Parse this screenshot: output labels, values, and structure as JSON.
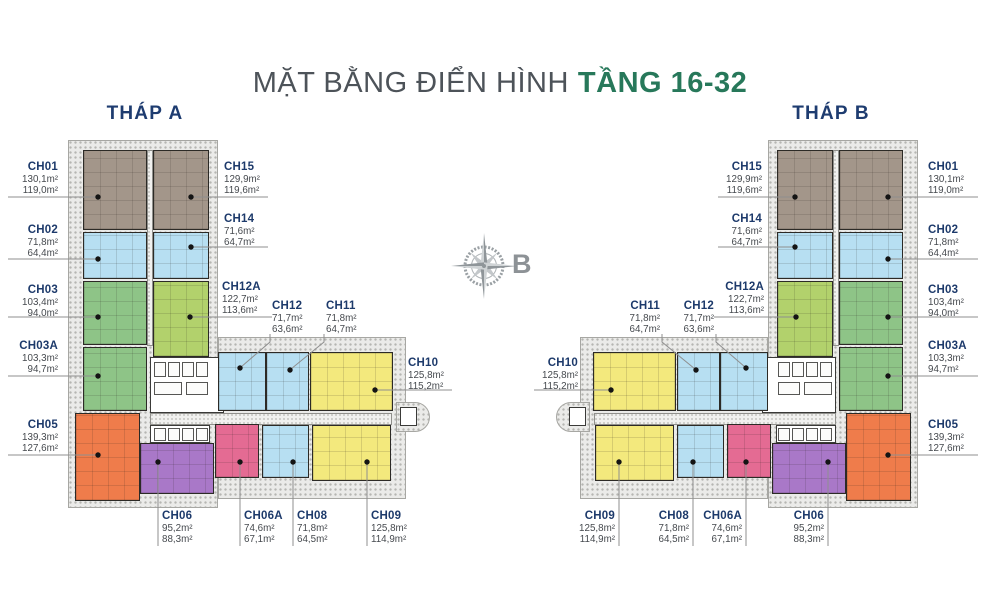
{
  "title": {
    "main": "MẶT BẰNG ĐIỂN HÌNH",
    "highlight": "TẦNG 16-32",
    "highlight_color": "#27785a"
  },
  "compass": {
    "label": "B"
  },
  "towers": [
    {
      "name": "THÁP A",
      "mirrored": false
    },
    {
      "name": "THÁP B",
      "mirrored": true
    }
  ],
  "palette": {
    "taupe": "#a3968a",
    "blue": "#b7dff2",
    "green": "#8ec487",
    "lightgreen": "#b2d16c",
    "orange": "#ef7c4b",
    "purple": "#a978c8",
    "pink": "#e46b93",
    "yellow": "#f3e97d"
  },
  "units": [
    {
      "code": "CH01",
      "areas": [
        "130,1m²",
        "119,0m²"
      ],
      "color": "taupe"
    },
    {
      "code": "CH02",
      "areas": [
        "71,8m²",
        "64,4m²"
      ],
      "color": "blue"
    },
    {
      "code": "CH03",
      "areas": [
        "103,4m²",
        "94,0m²"
      ],
      "color": "green"
    },
    {
      "code": "CH03A",
      "areas": [
        "103,3m²",
        "94,7m²"
      ],
      "color": "green"
    },
    {
      "code": "CH05",
      "areas": [
        "139,3m²",
        "127,6m²"
      ],
      "color": "orange"
    },
    {
      "code": "CH15",
      "areas": [
        "129,9m²",
        "119,6m²"
      ],
      "color": "taupe"
    },
    {
      "code": "CH14",
      "areas": [
        "71,6m²",
        "64,7m²"
      ],
      "color": "blue"
    },
    {
      "code": "CH12A",
      "areas": [
        "122,7m²",
        "113,6m²"
      ],
      "color": "lightgreen"
    },
    {
      "code": "CH12",
      "areas": [
        "71,7m²",
        "63,6m²"
      ],
      "color": "blue"
    },
    {
      "code": "CH11",
      "areas": [
        "71,8m²",
        "64,7m²"
      ],
      "color": "blue"
    },
    {
      "code": "CH10",
      "areas": [
        "125,8m²",
        "115,2m²"
      ],
      "color": "yellow"
    },
    {
      "code": "CH06",
      "areas": [
        "95,2m²",
        "88,3m²"
      ],
      "color": "purple"
    },
    {
      "code": "CH06A",
      "areas": [
        "74,6m²",
        "67,1m²"
      ],
      "color": "pink"
    },
    {
      "code": "CH08",
      "areas": [
        "71,8m²",
        "64,5m²"
      ],
      "color": "blue"
    },
    {
      "code": "CH09",
      "areas": [
        "125,8m²",
        "114,9m²"
      ],
      "color": "yellow"
    }
  ]
}
